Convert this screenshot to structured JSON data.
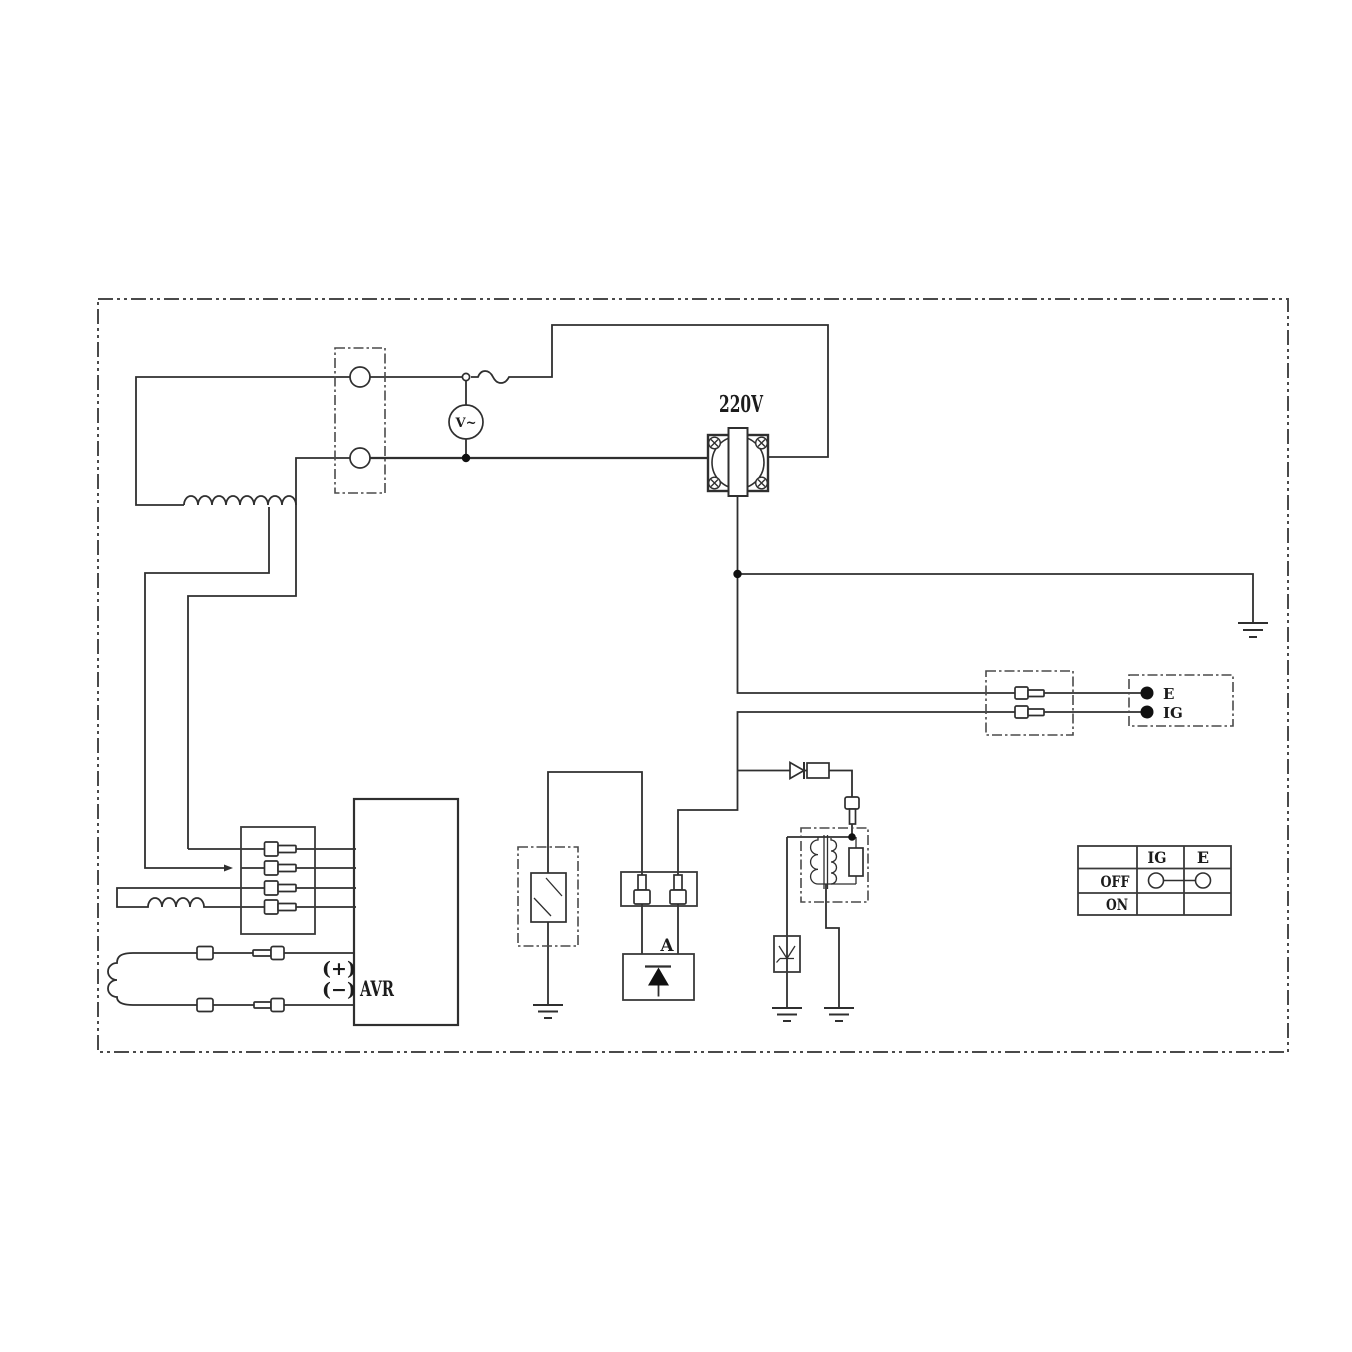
{
  "diagram_labels": {
    "outlet_voltage": "220V",
    "voltmeter": "V~",
    "avr": "AVR",
    "avr_plus": "(+)",
    "avr_minus": "(−)",
    "rectifier_unit": "A",
    "engine_terminal_e": "E",
    "engine_terminal_ig": "IG"
  },
  "switch_table": {
    "col_ig": "IG",
    "col_e": "E",
    "row_off": "OFF",
    "row_on": "ON",
    "off_row_connected": true,
    "on_row_connected": false
  },
  "components": [
    "generator-terminal-block",
    "voltmeter-icon",
    "fuse-icon",
    "power-outlet-220v",
    "earth-ground-icon",
    "engine-terminal-connector",
    "engine-terminals",
    "pilot-lamp",
    "lamp-connector-2pin",
    "rectifier-unit",
    "ignition-diode",
    "spark-plug-cap",
    "ignition-coil",
    "surge-arrester",
    "avr-unit",
    "stator-main-winding",
    "sub-winding",
    "charging-winding",
    "winding-connector-4pin",
    "switch-position-table"
  ],
  "colors": {
    "line": "#2f2f2f",
    "dashed_box": "#4a4a4a",
    "paper": "#ffffff",
    "solid_fill": "#111111"
  }
}
